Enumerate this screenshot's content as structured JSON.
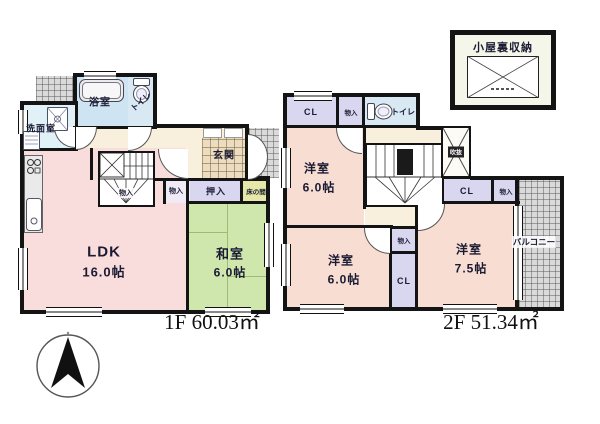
{
  "f1": {
    "area": "1F 60.03㎡",
    "ldk": {
      "name": "LDK",
      "size": "16.0帖"
    },
    "washitsu": {
      "name": "和室",
      "size": "6.0帖"
    },
    "bath": "浴室",
    "toilet": "トイレ",
    "washroom": "洗面室",
    "genkan": "玄関",
    "stair_storage": "物入",
    "storage": "物入",
    "oshiire": "押入",
    "tokonoma": "床の間"
  },
  "f2": {
    "area": "2F 51.34㎡",
    "room_nw": {
      "name": "洋室",
      "size": "6.0帖"
    },
    "room_sw": {
      "name": "洋室",
      "size": "6.0帖"
    },
    "room_e": {
      "name": "洋室",
      "size": "7.5帖"
    },
    "cl_top": "CL",
    "cl_mid": "CL",
    "cl_e": "CL",
    "storage_top": "物入",
    "storage_mid": "物入",
    "storage_e": "物入",
    "toilet": "トイレ",
    "void": "吹抜",
    "balcony": "バルコニー",
    "attic": "小屋裏収納"
  },
  "colors": {
    "wall": "#141414",
    "room_pink": "#f9dcdc",
    "room_peach": "#f7ddd2",
    "tatami_green": "#cfe6ad",
    "water_blue": "#cfe4f2",
    "closet_lavender": "#d9d6ef",
    "hall_cream": "#f8efdc",
    "entry_tile": "#ecdcc0",
    "tokonoma_yellow": "#e5e8a9",
    "hatch_gray": "#dadada"
  }
}
